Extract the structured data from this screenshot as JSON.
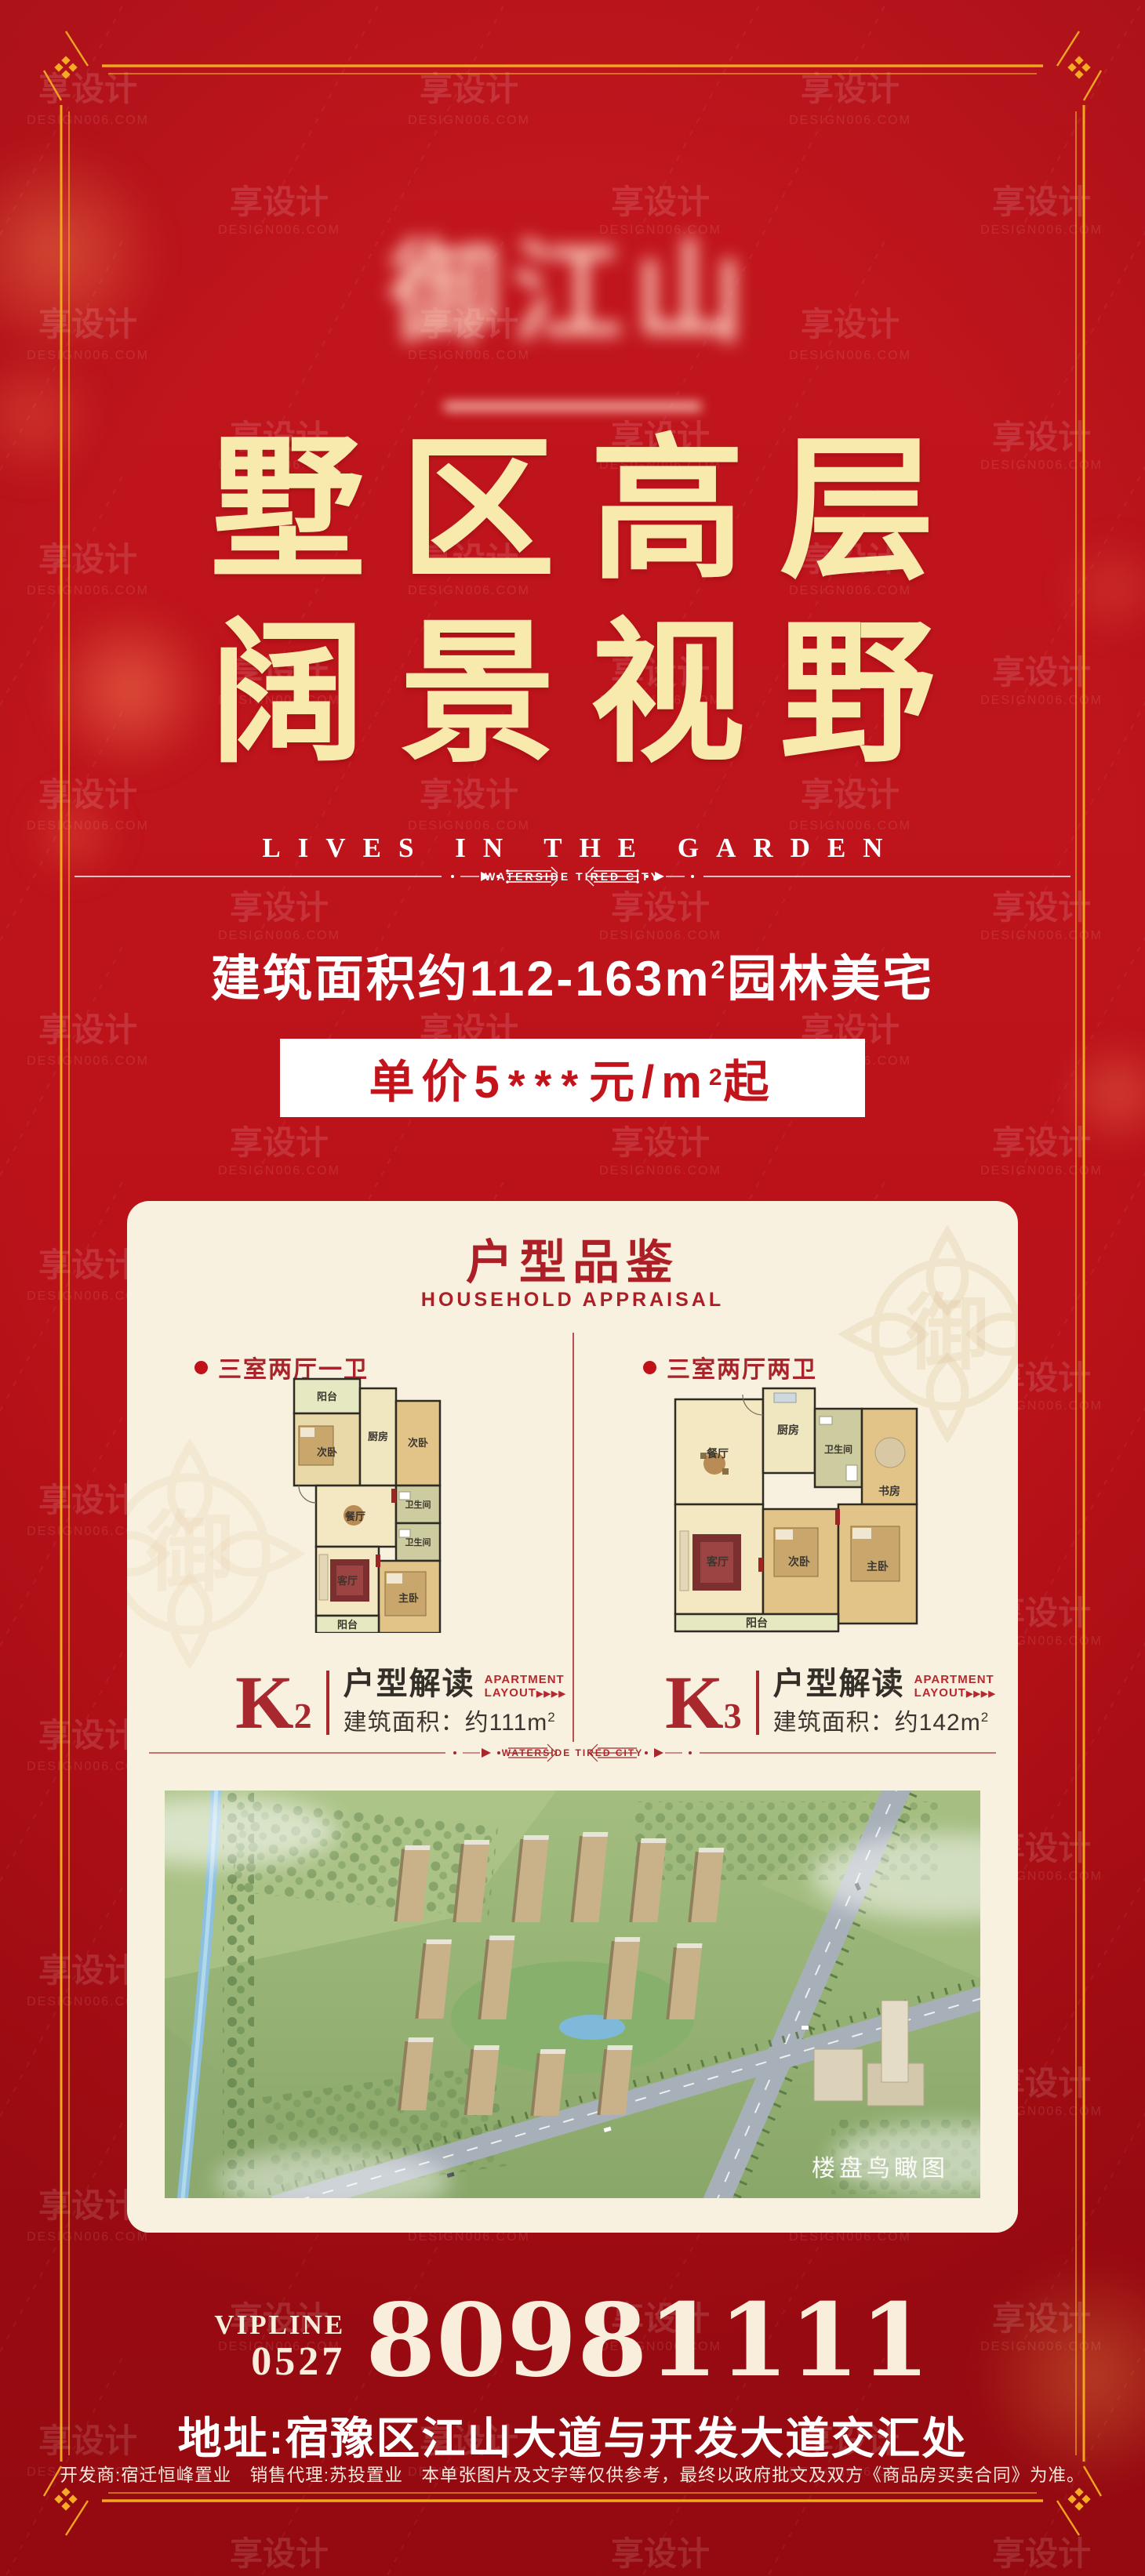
{
  "watermark": {
    "cn": "享设计",
    "en": "DESIGN006.COM"
  },
  "brand": {
    "logo_text": "御江山"
  },
  "hero": {
    "title_line1": "墅区高层",
    "title_line2": "阔景视野",
    "subtitle": "LIVES IN THE GARDEN"
  },
  "divider": {
    "label": "WATERSIDE TIRED CITY"
  },
  "offer": {
    "area_part1": "建筑面积约112-163m",
    "area_sup": "2",
    "area_part2": "园林美宅",
    "price_part1": "单价5",
    "price_stars": "***",
    "price_part2": "元/m",
    "price_sup": "2",
    "price_part3": "起"
  },
  "card": {
    "title": "户型品鉴",
    "subtitle": "HOUSEHOLD APPRAISAL",
    "divider_label": "WATERSIDE TIRED CITY",
    "ornament_char": "御",
    "aerial_caption": "楼盘鸟瞰图",
    "plans": [
      {
        "tag": "三室两厅一卫",
        "k_main": "K",
        "k_sub": "2",
        "name": "户型解读",
        "en1": "APARTMENT",
        "en2": "LAYOUT",
        "arrows": "▶▶▶▶",
        "area_prefix": "建筑面积：约111m",
        "area_sup": "2",
        "rooms": {
          "balcony_top": "阳台",
          "bed2a": "次卧",
          "kitchen": "厨房",
          "bed2b": "次卧",
          "dining": "餐厅",
          "bath1": "卫生间",
          "bath2": "卫生间",
          "living": "客厅",
          "master": "主卧",
          "balcony_bottom": "阳台"
        }
      },
      {
        "tag": "三室两厅两卫",
        "k_main": "K",
        "k_sub": "3",
        "name": "户型解读",
        "en1": "APARTMENT",
        "en2": "LAYOUT",
        "arrows": "▶▶▶▶",
        "area_prefix": "建筑面积：约142m",
        "area_sup": "2",
        "rooms": {
          "dining": "餐厅",
          "kitchen": "厨房",
          "bath": "卫生间",
          "study": "书房",
          "living": "客厅",
          "bed2": "次卧",
          "master": "主卧",
          "balcony": "阳台"
        }
      }
    ]
  },
  "contact": {
    "vip_label": "VIPLINE",
    "vip_code": "0527",
    "phone": "80981111",
    "address": "地址:宿豫区江山大道与开发大道交汇处",
    "disclaimer": "开发商:宿迁恒峰置业　销售代理:苏投置业　本单张图片及文字等仅供参考，最终以政府批文及双方《商品房买卖合同》为准。"
  },
  "colors": {
    "bg_red": "#bf141c",
    "gold": "#f2a51f",
    "title_cream": "#f8e9ad",
    "card_bg": "#f8f1df",
    "accent_red": "#ad1f26"
  }
}
